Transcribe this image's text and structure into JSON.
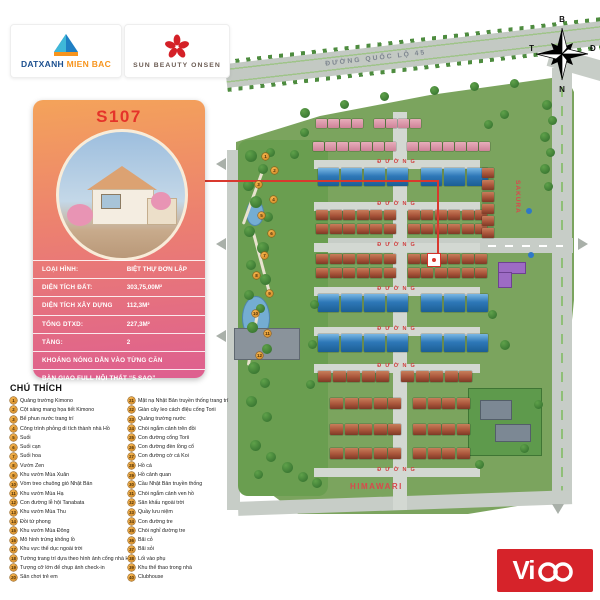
{
  "brand": {
    "datxanh": {
      "part1": "DATXANH",
      "part2": " MIEN BAC"
    },
    "sun_beauty": {
      "name": "SUN BEAUTY ONSEN"
    }
  },
  "compass": {
    "north": "B",
    "south": "N",
    "east": "Đ",
    "west": "T"
  },
  "unit_card": {
    "unit_code": "S107",
    "rows": [
      {
        "label": "LOẠI HÌNH:",
        "value": "BIỆT THỰ ĐƠN LẬP"
      },
      {
        "label": "DIỆN TÍCH ĐẤT:",
        "value": "303,75,00M²"
      },
      {
        "label": "DIỆN TÍCH XÂY DỰNG",
        "value": "112,3M²"
      },
      {
        "label": "TỔNG DTXD:",
        "value": "227,3M²"
      },
      {
        "label": "TẦNG:",
        "value": "2"
      },
      {
        "label": "KHOÁNG NÓNG DẪN VÀO TỪNG CĂN",
        "value": ""
      },
      {
        "label": "BÀN GIAO FULL NỘI THẤT “5 SAO”",
        "value": ""
      },
      {
        "label": "GIÁ CÓ VAT (CÓ HTLS):",
        "value": "33.423.971.216 VND"
      }
    ]
  },
  "map": {
    "highway_label": "ĐƯỜNG QUỐC LỘ 45",
    "street_label": "ĐƯỜNG",
    "street_label_ys": [
      162,
      204,
      245,
      289,
      329,
      366,
      470
    ],
    "zone_labels": {
      "sakura": "SAKURA",
      "himawari": "HIMAWARI"
    },
    "rows": [
      {
        "x": 316,
        "y": 119,
        "count": 8,
        "size": 11,
        "color": "pink"
      },
      {
        "x": 313,
        "y": 142,
        "count": 14,
        "size": 11,
        "color": "pink"
      },
      {
        "x": 318,
        "y": 168,
        "count": 7,
        "size": 21,
        "color": "blue"
      },
      {
        "x": 316,
        "y": 210,
        "count": 12,
        "size": 12,
        "color": "red"
      },
      {
        "x": 316,
        "y": 224,
        "count": 12,
        "size": 12,
        "color": "red"
      },
      {
        "x": 316,
        "y": 254,
        "count": 12,
        "size": 12,
        "color": "red"
      },
      {
        "x": 316,
        "y": 268,
        "count": 12,
        "size": 12,
        "color": "red"
      },
      {
        "x": 318,
        "y": 294,
        "count": 7,
        "size": 21,
        "color": "blue"
      },
      {
        "x": 318,
        "y": 334,
        "count": 7,
        "size": 21,
        "color": "blue"
      },
      {
        "x": 318,
        "y": 371,
        "count": 10,
        "size": 13,
        "color": "red"
      },
      {
        "x": 330,
        "y": 398,
        "count": 9,
        "size": 13,
        "color": "red"
      },
      {
        "x": 330,
        "y": 424,
        "count": 9,
        "size": 13,
        "color": "red"
      },
      {
        "x": 330,
        "y": 448,
        "count": 9,
        "size": 13,
        "color": "red"
      },
      {
        "x": 482,
        "y": 168,
        "count": 6,
        "size": 12,
        "color": "red",
        "vertical": true
      }
    ],
    "park_markers": [
      {
        "n": "1",
        "x": 262,
        "y": 153
      },
      {
        "n": "2",
        "x": 271,
        "y": 167
      },
      {
        "n": "3",
        "x": 255,
        "y": 181
      },
      {
        "n": "4",
        "x": 270,
        "y": 196
      },
      {
        "n": "5",
        "x": 258,
        "y": 212
      },
      {
        "n": "6",
        "x": 268,
        "y": 230
      },
      {
        "n": "7",
        "x": 261,
        "y": 252
      },
      {
        "n": "8",
        "x": 253,
        "y": 272
      },
      {
        "n": "9",
        "x": 266,
        "y": 290
      },
      {
        "n": "10",
        "x": 252,
        "y": 310
      },
      {
        "n": "11",
        "x": 264,
        "y": 330
      },
      {
        "n": "12",
        "x": 256,
        "y": 352
      }
    ]
  },
  "legend": {
    "title": "CHÚ THÍCH",
    "items": [
      "Quảng trường Kimono",
      "Cột sáng mang họa tiết Kimono",
      "Bể phun nước trang trí",
      "Công trình phỏng di tích thành nhà Hồ",
      "Suối",
      "Suối cạn",
      "Suối hoa",
      "Vườn Zen",
      "Khu vườn Mùa Xuân",
      "Vòm treo chuông gió Nhật Bản",
      "Khu vườn Mùa Hạ",
      "Con đường lễ hội Tanabata",
      "Khu vườn Mùa Thu",
      "Đồi tứ phong",
      "Khu vườn Mùa Đông",
      "Mô hình trứng khổng lồ",
      "Khu vực thể dục ngoài trời",
      "Tường trang trí dựa theo hình ảnh cổng nhà Hồ",
      "Tượng cỡ lớn để chụp ảnh check-in",
      "Sân chơi trẻ em",
      "Mặt nạ Nhật Bản truyền thống trang trí",
      "Giàn cây leo cách điệu cổng Torii",
      "Quảng trường nước",
      "Chòi ngắm cảnh trên đồi",
      "Con đường cổng Torii",
      "Con đường đèn lồng cổ",
      "Con đường cờ cá Koi",
      "Hồ cá",
      "Hồ cảnh quan",
      "Cầu Nhật Bản truyền thống",
      "Chòi ngắm cảnh ven hồ",
      "Sân khấu ngoài trời",
      "Quầy lưu niệm",
      "Con đường tre",
      "Chòi nghỉ đường tre",
      "Bãi cỏ",
      "Bãi sỏi",
      "Lối vào phụ",
      "Khu thể thao trong nhà",
      "Clubhouse"
    ]
  },
  "watermark": {
    "text": "Vico",
    "prefix": "Vi"
  }
}
